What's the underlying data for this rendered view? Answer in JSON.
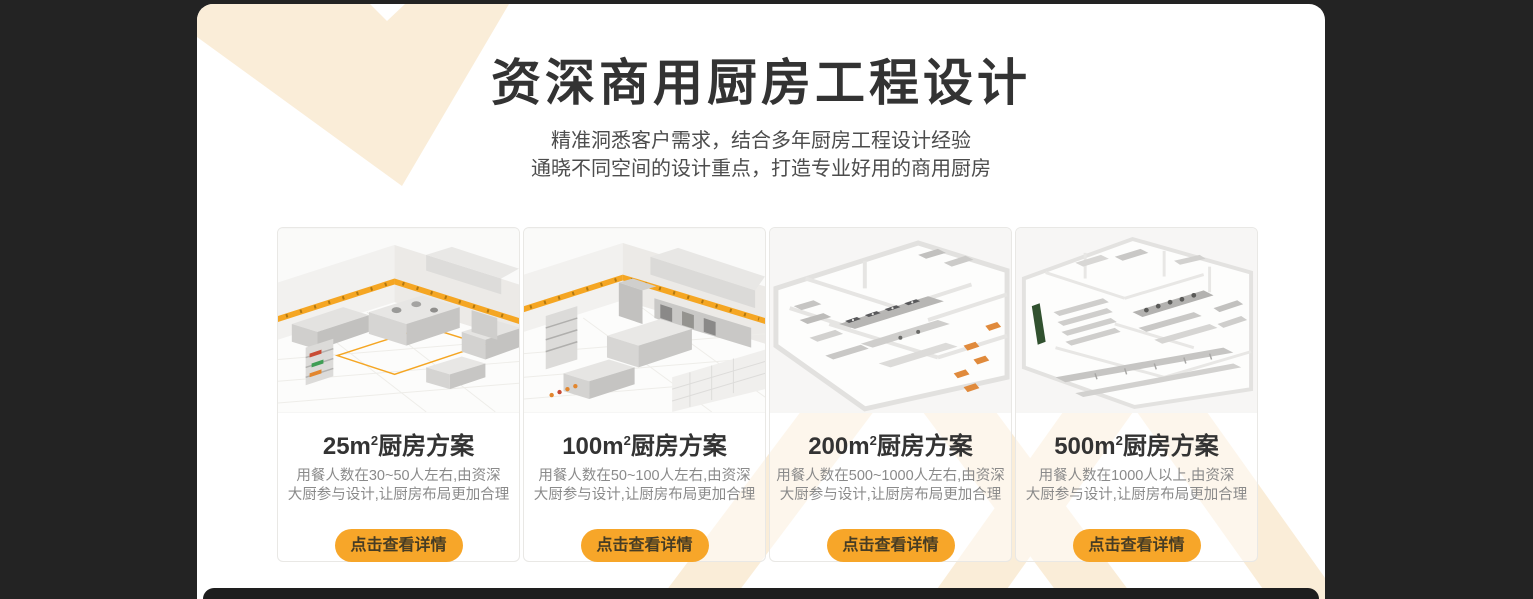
{
  "theme": {
    "page_background": "#232323",
    "panel_background": "#ffffff",
    "accent_orange": "#F7A629",
    "decoration_cream": "#FAEDD8",
    "title_color": "#333333",
    "description_color": "#8a8a8a",
    "button_text_color": "#463C24"
  },
  "header": {
    "title": "资深商用厨房工程设计",
    "subtitle_line1": "精准洞悉客户需求，结合多年厨房工程设计经验",
    "subtitle_line2": "通晓不同空间的设计重点，打造专业好用的商用厨房"
  },
  "cards": [
    {
      "title_size": "25m",
      "title_sup": "2",
      "title_suffix": "厨房方案",
      "desc_line1": "用餐人数在30~50人左右,由资深",
      "desc_line2": "大厨参与设计,让厨房布局更加合理",
      "button_label": "点击查看详情",
      "image": "kitchen-3d-plan-25"
    },
    {
      "title_size": "100m",
      "title_sup": "2",
      "title_suffix": "厨房方案",
      "desc_line1": "用餐人数在50~100人左右,由资深",
      "desc_line2": "大厨参与设计,让厨房布局更加合理",
      "button_label": "点击查看详情",
      "image": "kitchen-3d-plan-100"
    },
    {
      "title_size": "200m",
      "title_sup": "2",
      "title_suffix": "厨房方案",
      "desc_line1": "用餐人数在500~1000人左右,由资深",
      "desc_line2": "大厨参与设计,让厨房布局更加合理",
      "button_label": "点击查看详情",
      "image": "kitchen-3d-plan-200"
    },
    {
      "title_size": "500m",
      "title_sup": "2",
      "title_suffix": "厨房方案",
      "desc_line1": "用餐人数在1000人以上,由资深",
      "desc_line2": "大厨参与设计,让厨房布局更加合理",
      "button_label": "点击查看详情",
      "image": "kitchen-3d-plan-500"
    }
  ]
}
